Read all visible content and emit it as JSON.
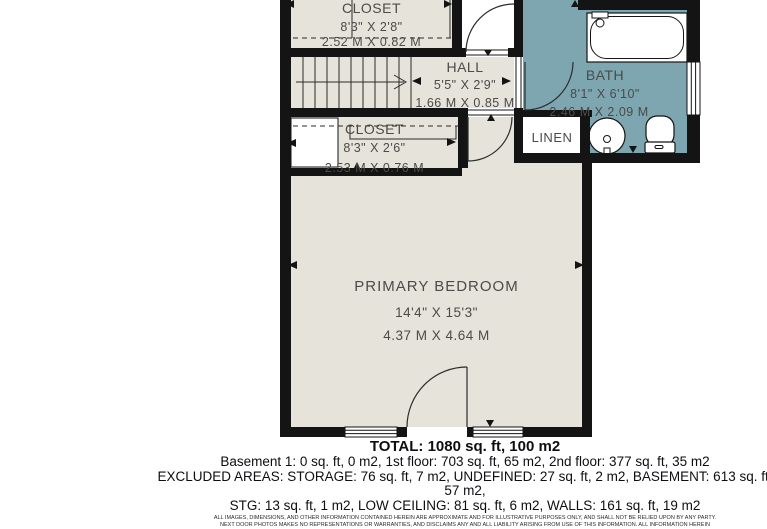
{
  "floorplan": {
    "rooms": {
      "closet_top": {
        "name": "CLOSET",
        "imperial": "8'3\" X 2'8\"",
        "metric": "2.52 M X 0.82 M"
      },
      "hall": {
        "name": "HALL",
        "imperial": "5'5\" X 2'9\"",
        "metric": "1.66 M X 0.85 M"
      },
      "bath": {
        "name": "BATH",
        "imperial": "8'1\" X 6'10\"",
        "metric": "2.46 M X 2.09 M"
      },
      "linen": {
        "name": "LINEN"
      },
      "closet_lower": {
        "name": "CLOSET",
        "imperial": "8'3\" X 2'6\"",
        "metric": "2.53 M X 0.76 M"
      },
      "primary_bedroom": {
        "name": "PRIMARY BEDROOM",
        "imperial": "14'4\" X 15'3\"",
        "metric": "4.37 M X 4.64 M"
      }
    },
    "colors": {
      "floor": "#e5e3da",
      "bath_floor": "#7da6b0",
      "walls": "#141414",
      "label_text": "#4b4b48"
    }
  },
  "summary": {
    "total": "TOTAL: 1080 sq. ft, 100 m2",
    "floors": "Basement 1: 0 sq. ft, 0 m2, 1st floor: 703 sq. ft, 65 m2, 2nd floor: 377 sq. ft, 35 m2",
    "excluded_line1": "EXCLUDED AREAS: STORAGE: 76 sq. ft, 7 m2, UNDEFINED: 27 sq. ft, 2 m2, BASEMENT: 613 sq. ft, 57 m2,",
    "excluded_line2": "STG: 13 sq. ft, 1 m2, LOW CEILING: 81 sq. ft, 6 m2, WALLS: 161 sq. ft, 19 m2",
    "disclaimer_line1": "ALL IMAGES, DIMENSIONS, AND OTHER INFORMATION CONTAINED HEREIN ARE APPROXIMATE AND FOR ILLUSTRATIVE PURPOSES ONLY, AND SHALL NOT BE RELIED UPON BY ANY PARTY.",
    "disclaimer_line2": "NEXT DOOR PHOTOS MAKES NO REPRESENTATIONS OR WARRANTIES, AND DISCLAIMS ANY AND ALL LIABILITY ARISING FROM USE OF THIS INFORMATION. ALL INFORMATION HEREIN"
  }
}
